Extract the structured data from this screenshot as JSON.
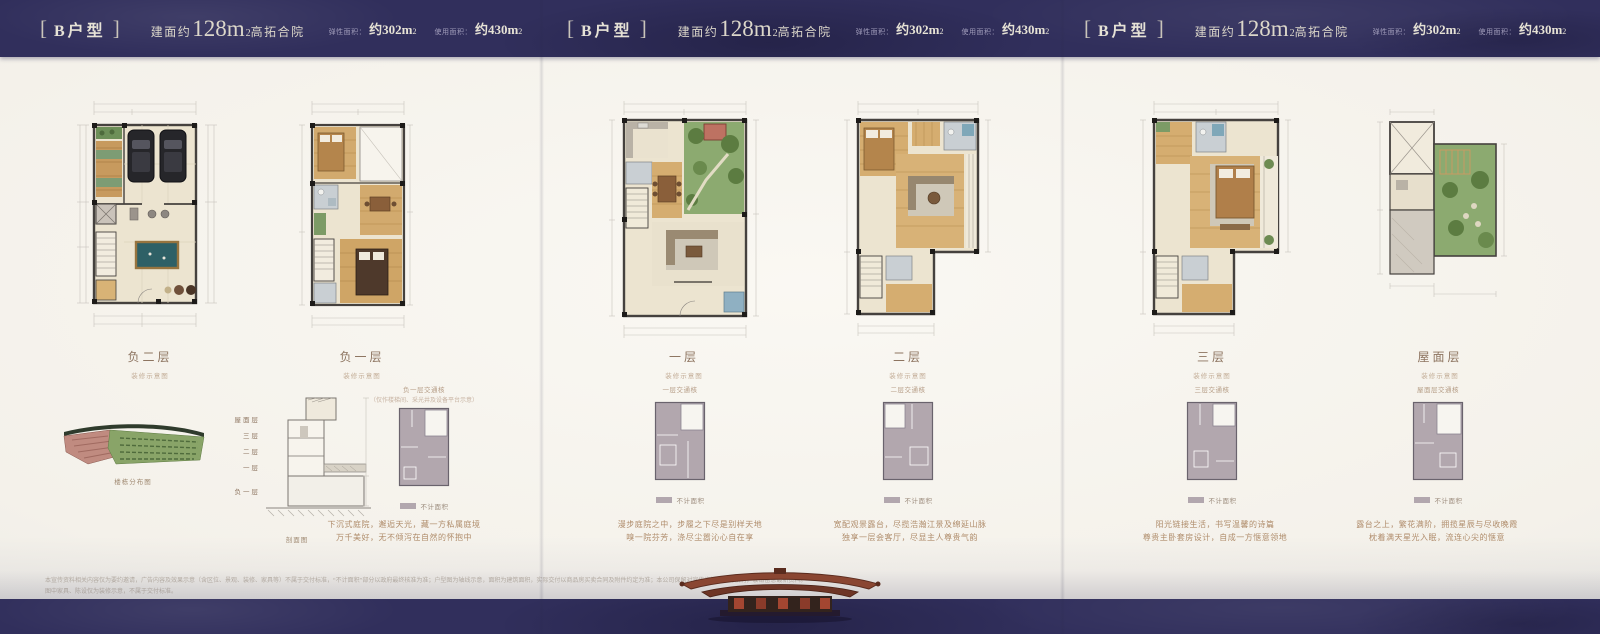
{
  "page": {
    "background": "#f7f5f0",
    "band_color": "#312f5c",
    "accent_text": "#e6e2d6"
  },
  "header": {
    "bracket_l": "[",
    "bracket_r": "]",
    "panels": [
      {
        "name": "B户型",
        "area_prefix": "建面约",
        "area_num": "128m",
        "area_sup": "2",
        "area_suffix": "高拓合院",
        "stats": [
          {
            "label": "弹性面积：",
            "value": "约302m",
            "sup": "2"
          },
          {
            "label": "使用面积：",
            "value": "约430m",
            "sup": "2"
          }
        ]
      },
      {
        "name": "B户型",
        "area_prefix": "建面约",
        "area_num": "128m",
        "area_sup": "2",
        "area_suffix": "高拓合院",
        "stats": [
          {
            "label": "弹性面积：",
            "value": "约302m",
            "sup": "2"
          },
          {
            "label": "使用面积：",
            "value": "约430m",
            "sup": "2"
          }
        ]
      },
      {
        "name": "B户型",
        "area_prefix": "建面约",
        "area_num": "128m",
        "area_sup": "2",
        "area_suffix": "高拓合院",
        "stats": [
          {
            "label": "弹性面积：",
            "value": "约302m",
            "sup": "2"
          },
          {
            "label": "使用面积：",
            "value": "约430m",
            "sup": "2"
          }
        ]
      }
    ]
  },
  "columns": [
    {
      "floor": "负二层",
      "sub": "装修示意图"
    },
    {
      "floor": "负一层",
      "sub": "装修示意图",
      "copy": [
        "下沉式庭院，邂逅天光，藏一方私属庭境",
        "万千美好，无不倾泻在自然的怀抱中"
      ]
    },
    {
      "floor": "一层",
      "sub": "装修示意图",
      "copy": [
        "漫步庭院之中，步履之下尽是别样天地",
        "嗅一院芬芳，涤尽尘嚣沁心自在享"
      ]
    },
    {
      "floor": "二层",
      "sub": "装修示意图",
      "copy": [
        "宽配观景露台，尽揽浩瀚江景及绵延山脉",
        "独享一层会客厅，尽显主人尊贵气韵"
      ]
    },
    {
      "floor": "三层",
      "sub": "装修示意图",
      "copy": [
        "阳光链接生活，书写温馨的诗篇",
        "尊贵主卧套房设计，自成一方惬意领地"
      ]
    },
    {
      "floor": "屋面层",
      "sub": "装修示意图",
      "copy": [
        "露台之上，繁花满阶，拥揽星辰与尽收晚霞",
        "枕着满天星光入眠，流连心尖的惬意"
      ]
    }
  ],
  "sitemap": {
    "label": "楼栋分布图"
  },
  "section": {
    "label": "剖面图",
    "floors": [
      "屋面层",
      "三层",
      "二层",
      "一层",
      "负一层"
    ]
  },
  "minis": [
    {
      "title": "负一层交通核",
      "note": "（仅作楼梯间、采光井及设备平台示意）",
      "legend": "不计面积"
    },
    {
      "title": "一层交通核",
      "legend": "不计面积"
    },
    {
      "title": "二层交通核",
      "legend": "不计面积"
    },
    {
      "title": "三层交通核",
      "legend": "不计面积"
    },
    {
      "title": "屋面层交通核",
      "legend": "不计面积"
    }
  ],
  "footer": {
    "line1": "本宣传资料相关内容仅为要约邀请，广告内容及效果示意（含区位、景观、装修、家具等）不属于交付标准，“不计面积”部分以政府最终核准为准；户型图为轴线示意，面积为建筑面积，实际交付以商品房买卖合同及附件约定为准；本公司保留对宣传资料修改的权利，敬请留意最新资料。",
    "line2": "图中家具、陈设仅为装修示意，不属于交付标准。"
  }
}
